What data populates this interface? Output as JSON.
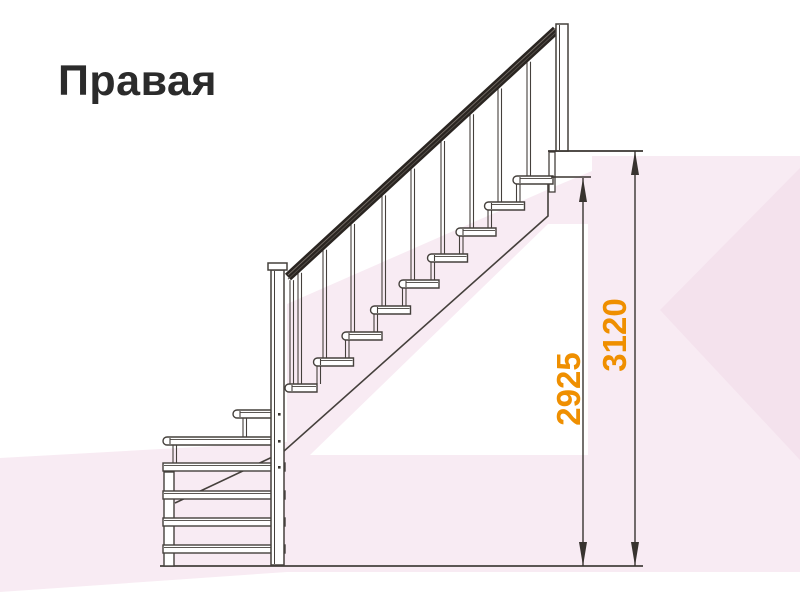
{
  "title": "Правая",
  "meaning": "Right-hand staircase side view",
  "colors": {
    "line": "#45403c",
    "dim_line": "#38332f",
    "rail_dark": "#2a2521",
    "rail_streak_light": "#7a726b",
    "rail_streak_dark": "#55504a",
    "accent_orange": "#ef8f00",
    "title_color": "#2b2b2b",
    "bg_pink": "#f8ebf3",
    "bg_pink_deep": "#f4e2ed",
    "white": "#ffffff"
  },
  "background": {
    "pink_polys": [
      {
        "points": "0,458 287,442 287,572 0,592",
        "tone": "light"
      },
      {
        "points": "287,304 556,186 592,171 592,572 287,572",
        "tone": "light"
      },
      {
        "points": "592,156 800,156 800,572 592,572",
        "tone": "light"
      },
      {
        "points": "800,168 800,460 660,310",
        "tone": "deep"
      }
    ],
    "white_polys": [
      "310,455 548,224 588,224 588,455",
      "0,594 800,576 800,600 0,600"
    ]
  },
  "dimensions": {
    "items": [
      {
        "id": "d2925",
        "label": "2925",
        "line_x": 583,
        "y_top": 178,
        "y_bottom": 566,
        "ext_y": 177,
        "ext_x1": 551,
        "ext_x2": 591,
        "label_x": 580,
        "label_y": 389
      },
      {
        "id": "d3120",
        "label": "3120",
        "line_x": 635,
        "y_top": 151,
        "y_bottom": 566,
        "ext_y": 151,
        "ext_x1": 548,
        "ext_x2": 643,
        "label_x": 626,
        "label_y": 335
      }
    ],
    "arrow": {
      "half_width": 4,
      "length": 24
    }
  },
  "stairs": {
    "flight": {
      "steps": 9,
      "tread_w": 40,
      "tread_h": 8,
      "run": 28.5,
      "rise": 26,
      "bottom_x": 285,
      "bottom_y": 384,
      "last_tread_w": 32
    },
    "handrail": {
      "x1": 288,
      "y1": 277,
      "x2": 556,
      "y2": 30,
      "thickness": 9
    },
    "balusters": {
      "xs": [
        290,
        298,
        323,
        351,
        382,
        411,
        441,
        470,
        498,
        527
      ],
      "bottoms": [
        384,
        384,
        358,
        332,
        306,
        280,
        254,
        228,
        202,
        176
      ],
      "gap": 3.5,
      "top_offset": 5
    },
    "posts": {
      "top": {
        "x": 556,
        "y": 24,
        "w": 12,
        "h": 127
      },
      "middle": {
        "x": 271,
        "y": 270,
        "w": 13,
        "h": 295,
        "cap": {
          "x": 268,
          "y": 263,
          "w": 19,
          "h": 7
        },
        "dots": [
          [
            278,
            413
          ],
          [
            278,
            440
          ],
          [
            278,
            466
          ]
        ]
      }
    },
    "plate": {
      "x": 549,
      "y": 152,
      "w": 6,
      "h": 40
    },
    "stringer": [
      [
        548,
        184
      ],
      [
        548,
        216
      ],
      [
        283,
        452
      ],
      [
        175,
        503
      ]
    ],
    "winder_treads": [
      {
        "x": 233,
        "y": 410,
        "w": 39,
        "bullnose": true
      },
      {
        "x": 163,
        "y": 437,
        "w": 109,
        "bullnose": true
      },
      {
        "x": 163,
        "y": 463,
        "w": 122,
        "bullnose": false
      },
      {
        "x": 163,
        "y": 491,
        "w": 122,
        "bullnose": false
      },
      {
        "x": 163,
        "y": 518,
        "w": 122,
        "bullnose": false
      },
      {
        "x": 163,
        "y": 545,
        "w": 122,
        "bullnose": false
      }
    ],
    "winder_struts": [
      {
        "x": 243,
        "y1": 418,
        "y2": 437
      },
      {
        "x": 173,
        "y1": 445,
        "y2": 463
      }
    ],
    "left_support": {
      "x": 164,
      "y": 472,
      "w": 10,
      "h": 94
    },
    "floor": {
      "x1": 160,
      "y": 566,
      "x2": 643
    },
    "upper_floor": {
      "x1": 548,
      "y": 151,
      "x2": 643
    }
  }
}
